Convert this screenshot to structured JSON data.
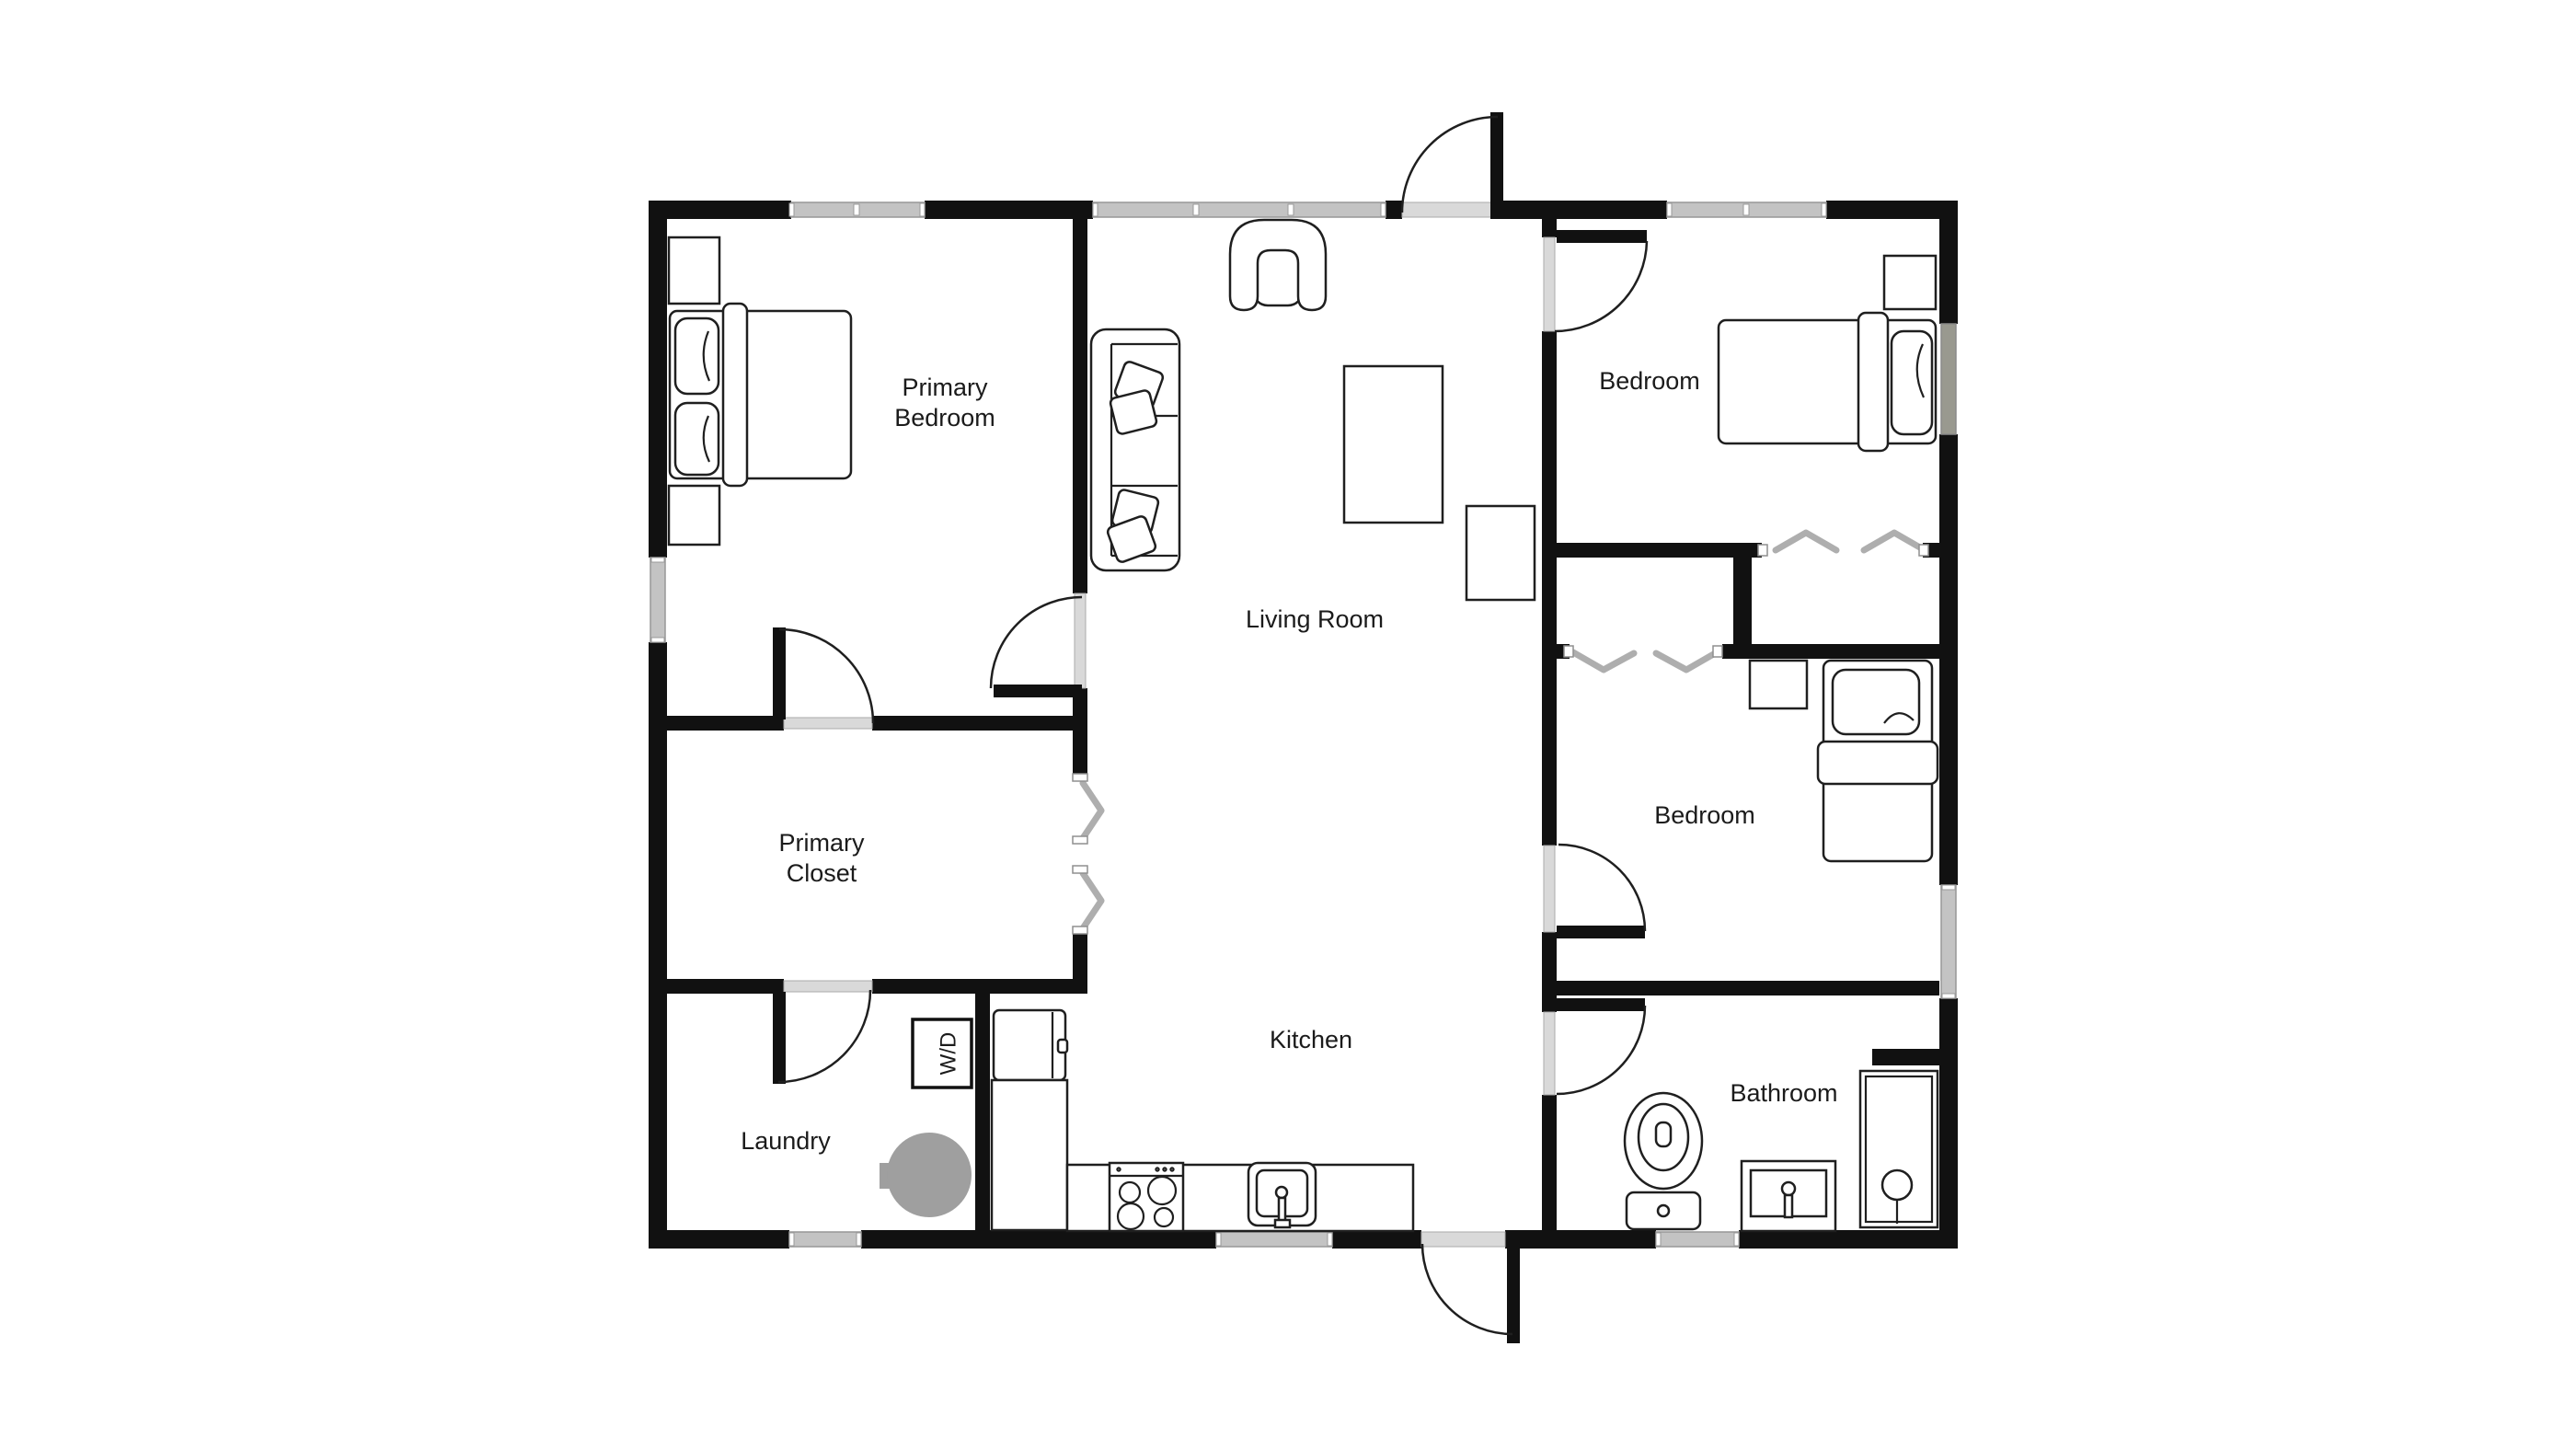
{
  "document": {
    "type": "residential-floor-plan",
    "background": "#ffffff"
  },
  "colors": {
    "wall": "#111111",
    "window": "#c3c3c3",
    "window_dark": "#99998f",
    "opening": "#d9d9d9",
    "line": "#1f1f1f",
    "bifold": "#aeaeae",
    "appliance": "#9f9f9f",
    "text": "#1b1b1b",
    "background": "#ffffff"
  },
  "rooms": [
    {
      "id": "primary-bedroom",
      "label": "Primary Bedroom",
      "label_lines": [
        "Primary",
        "Bedroom"
      ]
    },
    {
      "id": "bedroom-top-right",
      "label": "Bedroom",
      "label_lines": [
        "Bedroom"
      ]
    },
    {
      "id": "living-room",
      "label": "Living Room",
      "label_lines": [
        "Living Room"
      ]
    },
    {
      "id": "primary-closet",
      "label": "Primary Closet",
      "label_lines": [
        "Primary",
        "Closet"
      ]
    },
    {
      "id": "bedroom-mid-right",
      "label": "Bedroom",
      "label_lines": [
        "Bedroom"
      ]
    },
    {
      "id": "laundry",
      "label": "Laundry",
      "label_lines": [
        "Laundry"
      ]
    },
    {
      "id": "kitchen",
      "label": "Kitchen",
      "label_lines": [
        "Kitchen"
      ]
    },
    {
      "id": "bathroom",
      "label": "Bathroom",
      "label_lines": [
        "Bathroom"
      ]
    }
  ],
  "appliances": {
    "washer_dryer": "W/D"
  },
  "openings": {
    "exterior_doors": [
      "front-entry-top-wall",
      "rear-door-kitchen-bottom-wall"
    ],
    "interior_doors": [
      "primary-bedroom-door",
      "primary-closet-door",
      "laundry-door",
      "bedroom-top-right-door",
      "bedroom-mid-right-door",
      "bathroom-door"
    ],
    "bifold_closets": [
      "hallway-closet-double",
      "bedroom-top-right-closet",
      "bedroom-mid-right-closet"
    ],
    "window_count": 9
  },
  "furniture": {
    "primary_bedroom": [
      "double-bed",
      "nightstand",
      "nightstand"
    ],
    "living_room": [
      "armchair",
      "sofa",
      "coffee-table",
      "side-table"
    ],
    "bedroom_top_right": [
      "bed",
      "nightstand"
    ],
    "bedroom_mid_right": [
      "bed",
      "nightstand"
    ],
    "kitchen": [
      "refrigerator",
      "counter",
      "stove",
      "sink"
    ],
    "laundry": [
      "washer-dryer-unit",
      "water-heater"
    ],
    "bathroom": [
      "toilet",
      "vanity-sink",
      "shower"
    ]
  }
}
